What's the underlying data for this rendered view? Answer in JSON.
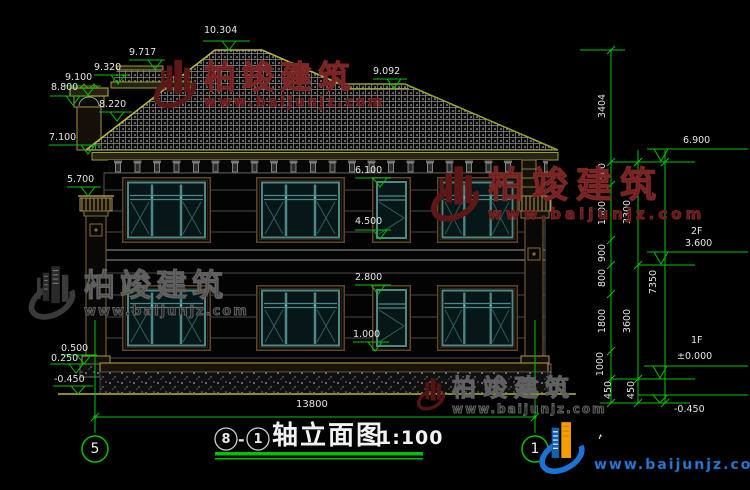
{
  "title": {
    "axis_start": "8",
    "separator": "-",
    "axis_end": "1",
    "name": "轴立面图",
    "scale": "1:100"
  },
  "axis_bubbles": {
    "left": "5",
    "right": "1"
  },
  "levels": {
    "left": {
      "ridge": "10.304",
      "dormer_ridge": "9.717",
      "dormer_eave": "9.320",
      "chimney_top": "9.100",
      "chimney_cap": "8.800",
      "roof_surface": "8.220",
      "eave": "7.100",
      "column_top": "5.700",
      "coping_top": "0.500",
      "coping_mid": "0.250",
      "ground": "-0.450"
    },
    "center": {
      "window_head_2f": "6.100",
      "window_sill_2f": "4.500",
      "window_head_1f": "2.800",
      "window_sill_1f": "1.000"
    },
    "right": {
      "wing_ridge": "9.092",
      "eave": "6.900",
      "floor2_label": "2F",
      "floor2_level": "3.600",
      "floor1_label": "1F",
      "floor1_level": "±0.000",
      "ground": "-0.450"
    }
  },
  "dimensions": {
    "total_width": "13800",
    "chain_inner": [
      "3404",
      "800",
      "1600",
      "900",
      "800",
      "1800",
      "1000",
      "450"
    ],
    "chain_middle": [
      "3300",
      "3600",
      "450"
    ],
    "chain_outer": [
      "7350"
    ]
  },
  "watermark": {
    "brand": "柏竣建筑",
    "url": "www.baijunjz.com"
  }
}
